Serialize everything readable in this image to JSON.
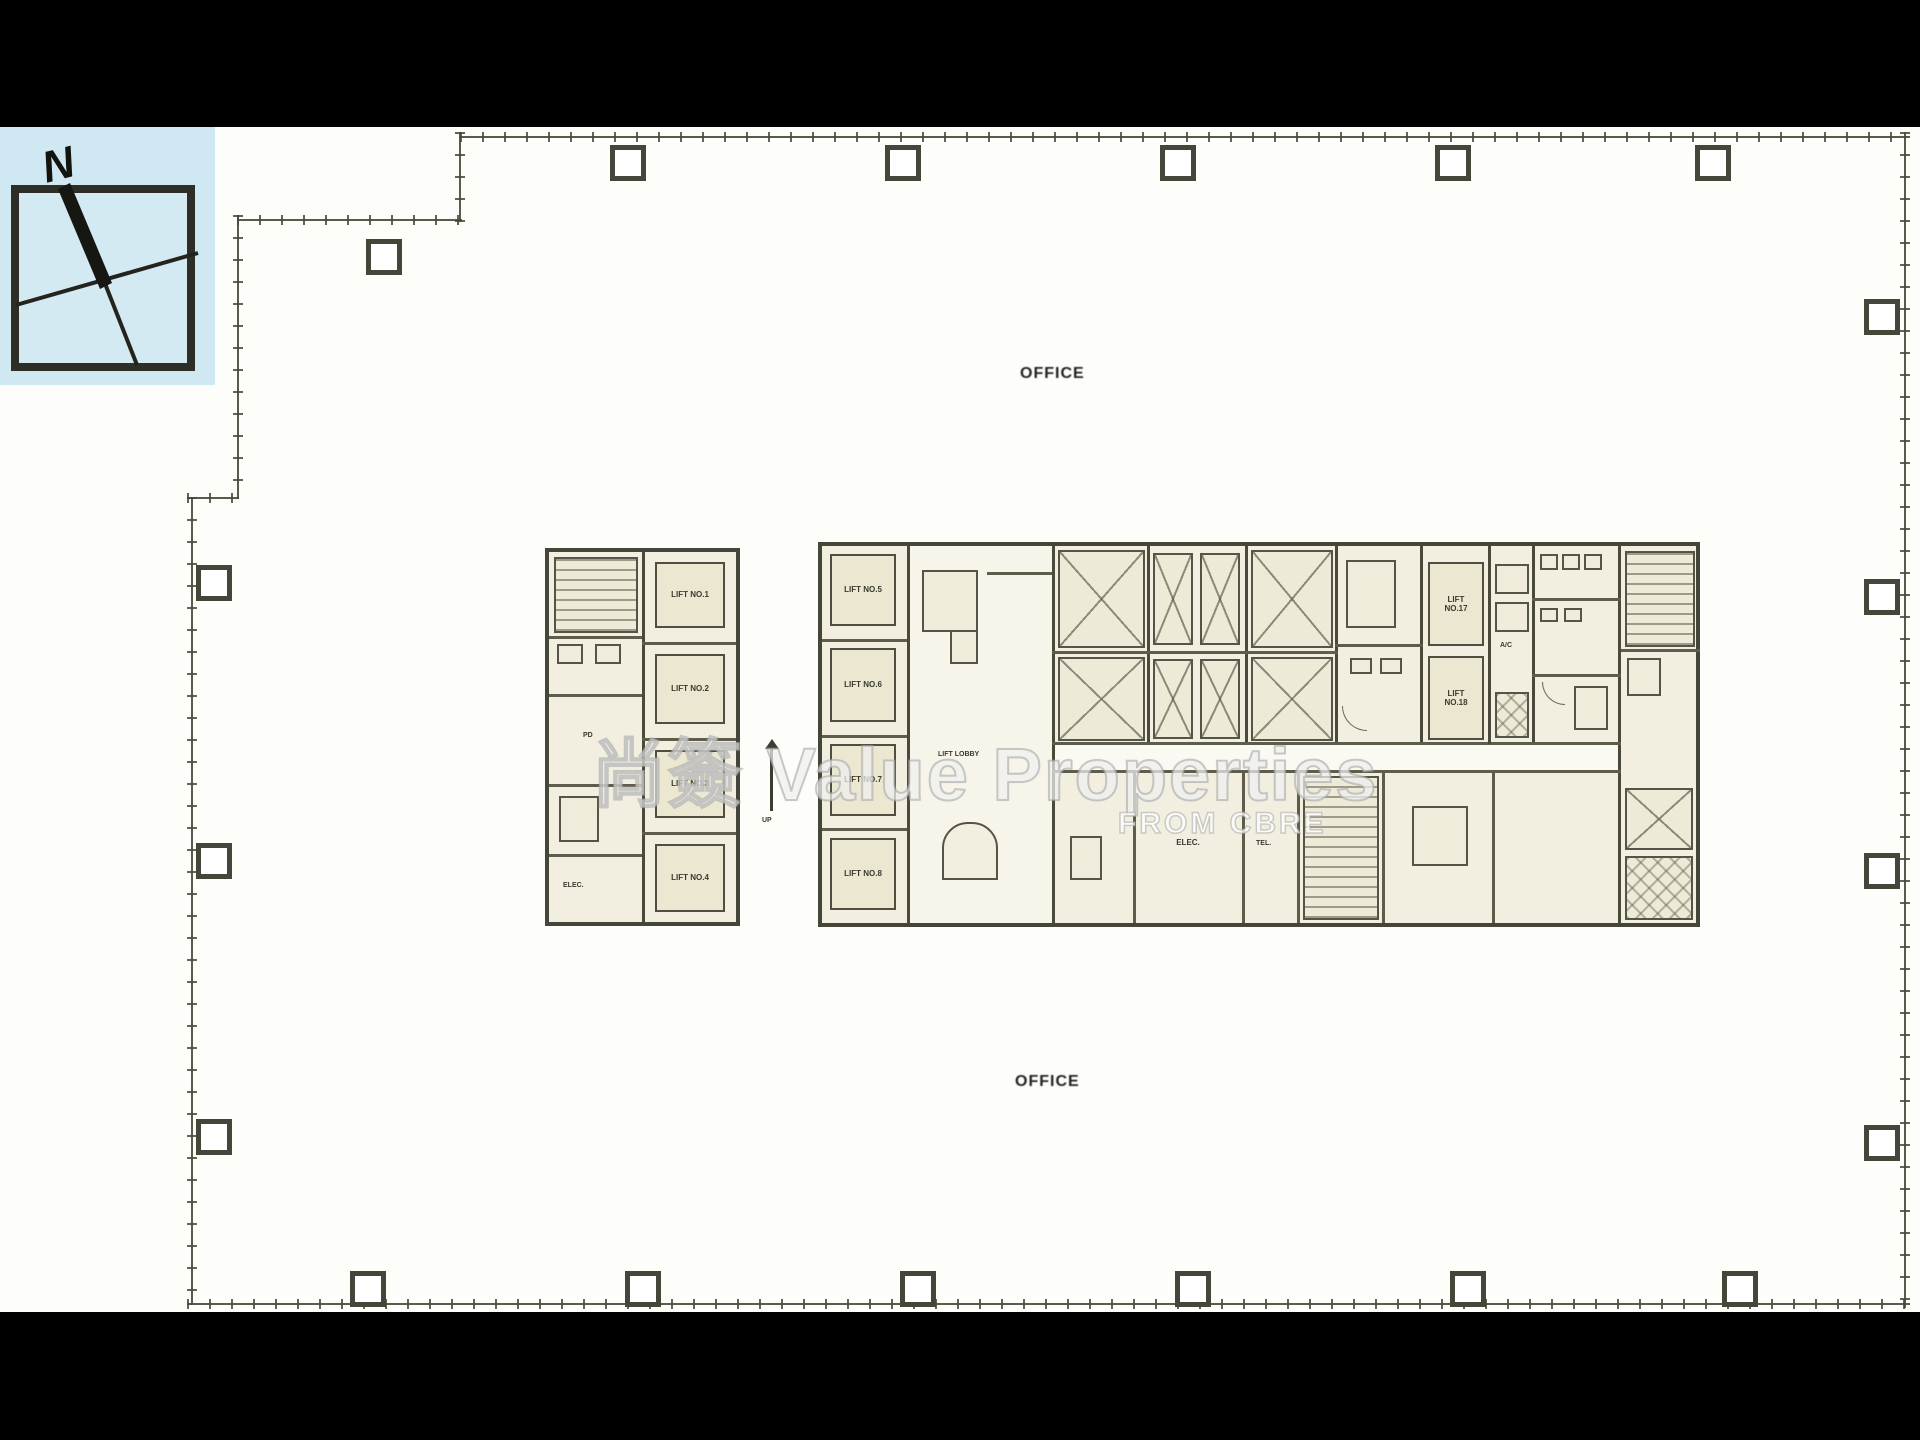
{
  "compass": {
    "north_label": "N"
  },
  "watermark": {
    "title": "尚簽 Value Properties",
    "subtitle": "FROM CBRE"
  },
  "labels": {
    "office_top": "OFFICE",
    "office_bottom": "OFFICE",
    "lift_lobby": "LIFT LOBBY",
    "up": "UP",
    "elec": "ELEC.",
    "tel": "TEL.",
    "pd": "PD",
    "ac": "A/C"
  },
  "left_core": {
    "lifts": [
      "LIFT NO.1",
      "LIFT NO.2",
      "LIFT NO.3",
      "LIFT NO.4"
    ]
  },
  "main_core": {
    "west_lifts": [
      "LIFT NO.5",
      "LIFT NO.6",
      "LIFT NO.7",
      "LIFT NO.8"
    ],
    "east_lifts": [
      "LIFT NO.17",
      "LIFT NO.18"
    ]
  },
  "colors": {
    "letterbox": "#000000",
    "background": "#fdfdfa",
    "wall": "#4a4a3a",
    "room_fill": "#efecdb",
    "compass_bg": "#cfe8f2",
    "watermark": "#ffffff"
  }
}
